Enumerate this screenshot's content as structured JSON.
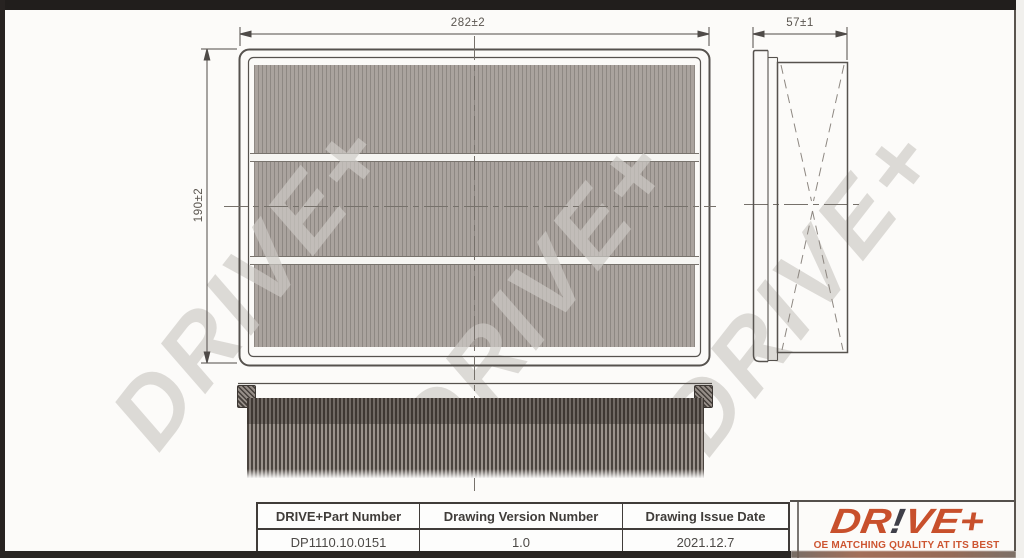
{
  "drawing": {
    "top_view": {
      "width_dim": "282±2",
      "height_dim": "190±2"
    },
    "side_view": {
      "width_dim": "57±1"
    },
    "watermark_text": "DRIVE+"
  },
  "table": {
    "headers": [
      "DRIVE+Part Number",
      "Drawing Version Number",
      "Drawing Issue Date"
    ],
    "row": [
      "DP1110.10.0151",
      "1.0",
      "2021.12.7"
    ]
  },
  "brand": {
    "logo_part1": "DR",
    "logo_bang": "!",
    "logo_part2": "VE+",
    "tagline": "OE MATCHING QUALITY AT ITS BEST",
    "colors": {
      "logo": "#c8502c",
      "bang": "#3f3f49",
      "tagline": "#cd5531"
    }
  }
}
